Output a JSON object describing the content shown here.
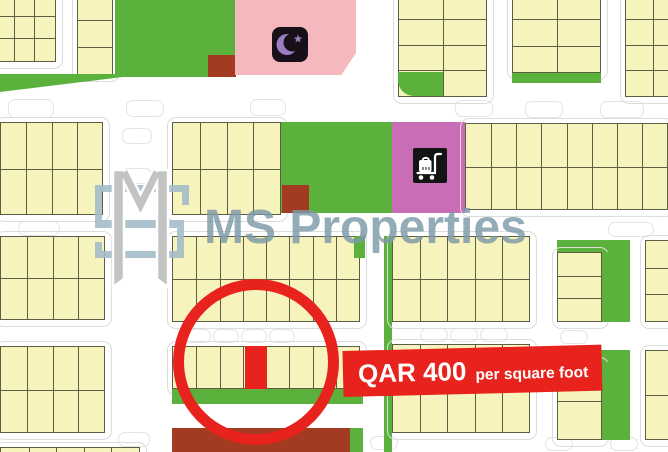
{
  "title": "Property plot map",
  "watermark": {
    "text": "MS Properties",
    "color": "#7d9aa8"
  },
  "logo": {
    "name": "ms-properties-monogram",
    "m_color": "#bdbdbd",
    "s_color": "#a5bdc9"
  },
  "price_banner": {
    "amount": "QAR 400",
    "unit": "per square foot",
    "bg_color": "#e8231d",
    "text_color": "#ffffff"
  },
  "annotations": {
    "highlight_circle": {
      "color": "#e8231d",
      "center_x": 256,
      "center_y": 362,
      "radius": 83
    },
    "highlighted_plot": {
      "color": "#e8231d",
      "x": 245,
      "y": 346,
      "w": 22,
      "h": 43
    }
  },
  "icons": [
    {
      "name": "mosque-crescent-icon",
      "bg": "#171019",
      "glyph_color": "#9b7ec1"
    },
    {
      "name": "shopping-cart-icon",
      "bg": "#141414",
      "glyph_color": "#ffffff"
    }
  ],
  "palette": {
    "plot_fill": "#f7f3bc",
    "plot_border": "#5c5d45",
    "park_green": "#5cb13c",
    "facility_brown": "#a23b22",
    "mosque_pink": "#f5b9bd",
    "retail_magenta": "#c96db7",
    "highlight_red": "#e8231d",
    "road_line": "#dcdcdc"
  },
  "map": {
    "width": 668,
    "height": 452,
    "blocks": [
      {
        "kind": "grid",
        "x": -8,
        "y": -8,
        "w": 64,
        "h": 70,
        "cols": 3,
        "rows": 3
      },
      {
        "kind": "grid",
        "x": 77,
        "y": -8,
        "w": 36,
        "h": 83,
        "cols": 1,
        "rows": 3
      },
      {
        "kind": "green",
        "x": 115,
        "y": -4,
        "w": 120,
        "h": 81
      },
      {
        "kind": "brown",
        "x": 208,
        "y": 55,
        "w": 28,
        "h": 22
      },
      {
        "kind": "pink",
        "x": 235,
        "y": -4,
        "w": 121,
        "h": 79,
        "clip": "polygon(0 0, 100% 0, 100% 72%, 88% 100%, 0 100%)"
      },
      {
        "kind": "grid",
        "x": 398,
        "y": -8,
        "w": 89,
        "h": 105,
        "cols": 2,
        "rows": 4
      },
      {
        "kind": "green",
        "x": 398,
        "y": 72,
        "w": 45,
        "h": 24,
        "radius": "0 0 0 16px"
      },
      {
        "kind": "grid",
        "x": 512,
        "y": -8,
        "w": 89,
        "h": 81,
        "cols": 2,
        "rows": 3
      },
      {
        "kind": "green",
        "x": 512,
        "y": 73,
        "w": 89,
        "h": 10
      },
      {
        "kind": "grid",
        "x": 625,
        "y": -8,
        "w": 55,
        "h": 105,
        "cols": 2,
        "rows": 4
      },
      {
        "kind": "green",
        "x": 0,
        "y": 74,
        "w": 148,
        "h": 18,
        "clip": "polygon(0 0, 100% 0, 0 100%)"
      },
      {
        "kind": "grid",
        "x": 0,
        "y": 122,
        "w": 103,
        "h": 93,
        "cols": 4,
        "rows": 2
      },
      {
        "kind": "grid",
        "x": 172,
        "y": 122,
        "w": 109,
        "h": 93,
        "cols": 4,
        "rows": 2
      },
      {
        "kind": "green",
        "x": 281,
        "y": 122,
        "w": 111,
        "h": 91
      },
      {
        "kind": "brown",
        "x": 282,
        "y": 185,
        "w": 27,
        "h": 28
      },
      {
        "kind": "magenta",
        "x": 392,
        "y": 122,
        "w": 73,
        "h": 91
      },
      {
        "kind": "grid",
        "x": 465,
        "y": 123,
        "w": 203,
        "h": 87,
        "cols": 8,
        "rows": 2
      },
      {
        "kind": "grid",
        "x": 0,
        "y": 236,
        "w": 105,
        "h": 84,
        "cols": 4,
        "rows": 2
      },
      {
        "kind": "grid",
        "x": 172,
        "y": 236,
        "w": 188,
        "h": 86,
        "cols": 8,
        "rows": 2
      },
      {
        "kind": "green",
        "x": 354,
        "y": 236,
        "w": 11,
        "h": 22
      },
      {
        "kind": "green",
        "x": 384,
        "y": 236,
        "w": 8,
        "h": 216
      },
      {
        "kind": "grid",
        "x": 392,
        "y": 236,
        "w": 138,
        "h": 86,
        "cols": 5,
        "rows": 2
      },
      {
        "kind": "green",
        "x": 557,
        "y": 240,
        "w": 73,
        "h": 12
      },
      {
        "kind": "grid",
        "x": 557,
        "y": 252,
        "w": 45,
        "h": 70,
        "cols": 1,
        "rows": 3
      },
      {
        "kind": "green",
        "x": 602,
        "y": 252,
        "w": 28,
        "h": 70
      },
      {
        "kind": "grid",
        "x": 645,
        "y": 240,
        "w": 30,
        "h": 82,
        "cols": 1,
        "rows": 3
      },
      {
        "kind": "grid",
        "x": 0,
        "y": 346,
        "w": 105,
        "h": 87,
        "cols": 4,
        "rows": 2
      },
      {
        "kind": "grid",
        "x": 172,
        "y": 346,
        "w": 188,
        "h": 43,
        "cols": 8,
        "rows": 1
      },
      {
        "kind": "green",
        "x": 172,
        "y": 389,
        "w": 191,
        "h": 15
      },
      {
        "kind": "brown",
        "x": 172,
        "y": 428,
        "w": 178,
        "h": 24
      },
      {
        "kind": "green",
        "x": 350,
        "y": 428,
        "w": 13,
        "h": 24
      },
      {
        "kind": "grid",
        "x": 392,
        "y": 344,
        "w": 138,
        "h": 89,
        "cols": 5,
        "rows": 2
      },
      {
        "kind": "green",
        "x": 557,
        "y": 350,
        "w": 73,
        "h": 12
      },
      {
        "kind": "grid",
        "x": 557,
        "y": 362,
        "w": 45,
        "h": 78,
        "cols": 1,
        "rows": 2
      },
      {
        "kind": "green",
        "x": 602,
        "y": 362,
        "w": 28,
        "h": 78
      },
      {
        "kind": "grid",
        "x": 645,
        "y": 350,
        "w": 30,
        "h": 90,
        "cols": 1,
        "rows": 2
      },
      {
        "kind": "grid",
        "x": 0,
        "y": 447,
        "w": 140,
        "h": 12,
        "cols": 5,
        "rows": 1
      }
    ]
  }
}
